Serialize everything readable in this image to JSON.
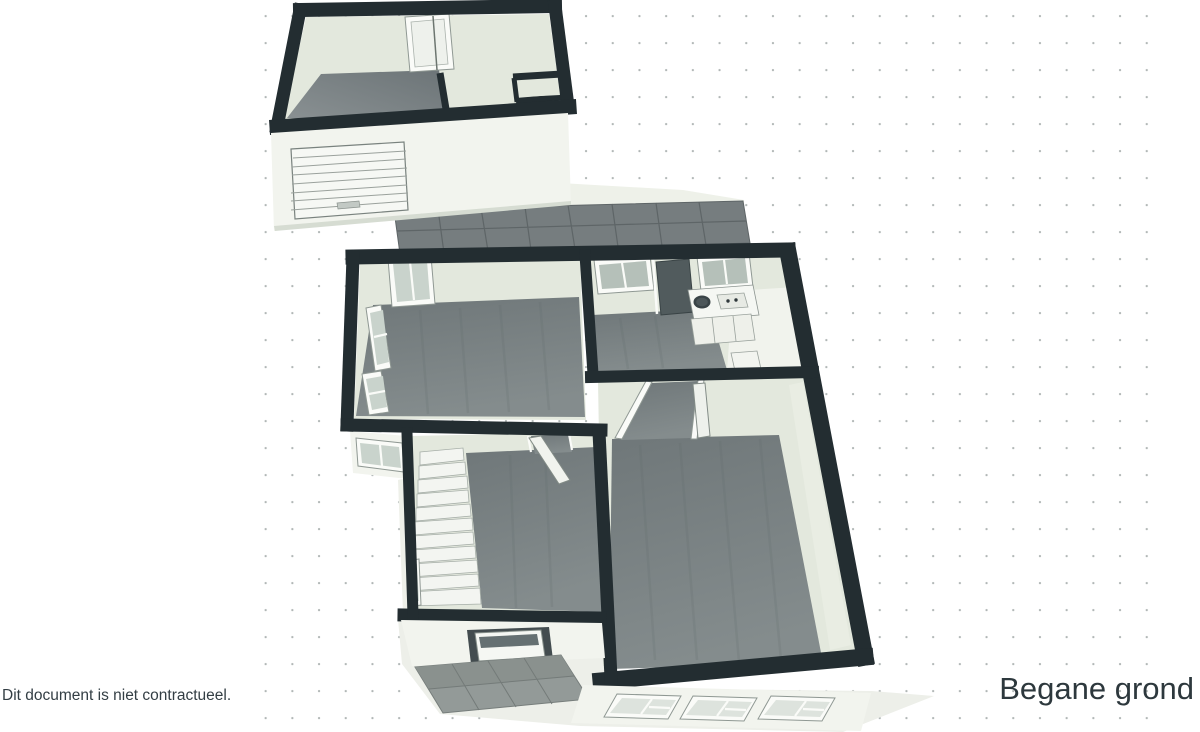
{
  "canvas": {
    "disclaimer": "Dit document is niet contractueel.",
    "floor_label": "Begane grond"
  },
  "palette": {
    "background": "#ffffff",
    "dot": "#b0b6b5",
    "wall_dark": "#232d31",
    "wall_face": "#e3e8dd",
    "exterior": "#f2f4ee",
    "wood": "#7a8182",
    "concrete": "#6e7578",
    "tile": "#767d7f",
    "tile_grout": "#5e6567",
    "porch_tile": "#939a98",
    "ground": "#edefe9",
    "glass": "#c9d3cc",
    "glass_dark": "#b5c0b9",
    "trim_white": "#fafbf8",
    "door_leaf_dark": "#515b5d",
    "text": "#333e44",
    "title": "#2d383d"
  }
}
